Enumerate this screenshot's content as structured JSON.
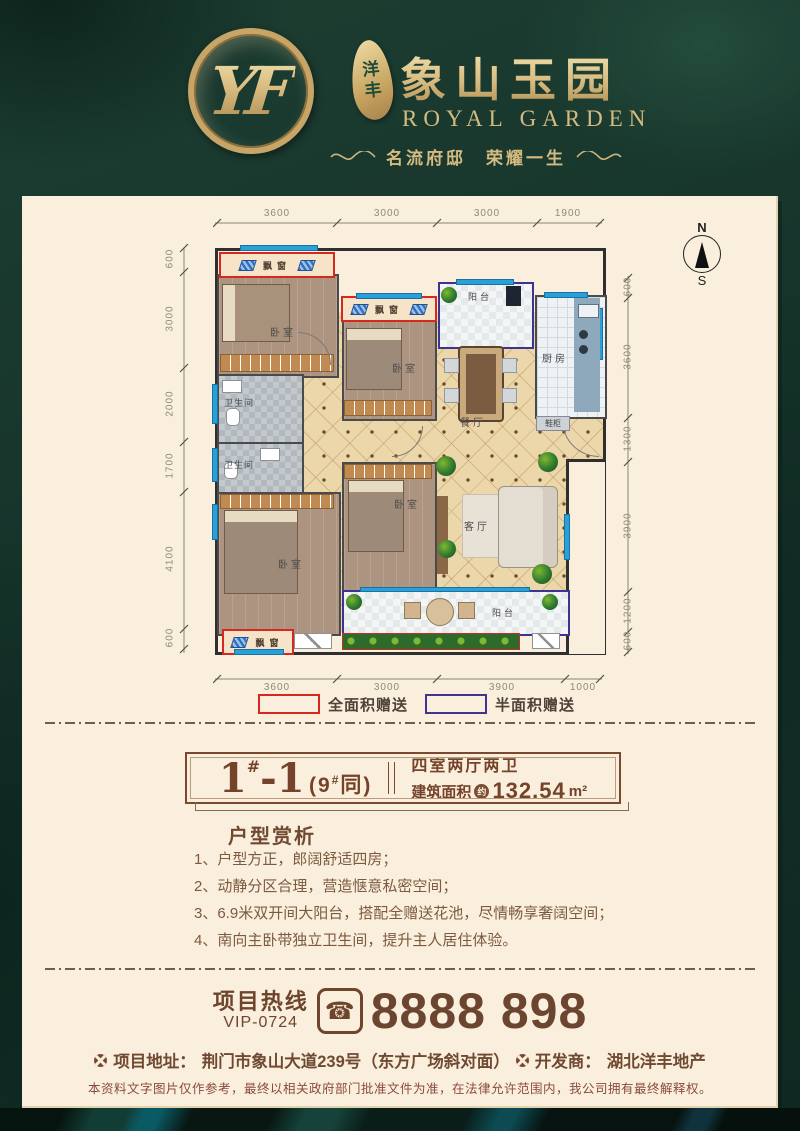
{
  "brand": {
    "monogram": "YF",
    "badge_top": "洋",
    "badge_bottom": "丰",
    "title": "象山玉园",
    "subtitle": "ROYAL  GARDEN",
    "tagline": "名流府邸　荣耀一生"
  },
  "plan": {
    "compass_n": "N",
    "compass_s": "S",
    "dims_top": [
      "3600",
      "3000",
      "3000",
      "1900"
    ],
    "dims_left": [
      "600",
      "3000",
      "2000",
      "1700",
      "4100",
      "600"
    ],
    "dims_right": [
      "600",
      "3600",
      "1300",
      "3900",
      "1200",
      "600"
    ],
    "dims_bottom": [
      "3600",
      "3000",
      "3900",
      "1000"
    ],
    "labels": {
      "bedroom": "卧室",
      "bath": "卫生间",
      "kitchen": "厨房",
      "dining": "餐厅",
      "living": "客厅",
      "balcony": "阳台",
      "bay": "飘窗",
      "shoe": "鞋柜"
    }
  },
  "legend": [
    {
      "label": "全面积赠送",
      "color": "#d5281f"
    },
    {
      "label": "半面积赠送",
      "color": "#3e3390"
    }
  ],
  "unit": {
    "big": "1",
    "sup": "#",
    "rest": "-1",
    "note_open": "(9",
    "note_sup": "#",
    "note_close": "同)"
  },
  "info": {
    "rooms": "四室两厅两卫",
    "area_label": "建筑面积",
    "area_circle": "约",
    "area_value": "132.54",
    "area_unit": "m²"
  },
  "analysis": {
    "heading": "户型赏析",
    "items": [
      "1、户型方正，郎阔舒适四房；",
      "2、动静分区合理，营造惬意私密空间；",
      "3、6.9米双开间大阳台，搭配全赠送花池，尽情畅享奢阔空间；",
      "4、南向主卧带独立卫生间，提升主人居住体验。"
    ]
  },
  "hotline": {
    "label": "项目热线",
    "vip": "VIP-0724",
    "phone_glyph": "☎",
    "number": "8888 898"
  },
  "footer": {
    "address_label": "项目地址：",
    "address": "荆门市象山大道239号（东方广场斜对面）",
    "developer_label": "开发商：",
    "developer": "湖北洋丰地产",
    "disclaimer": "本资料文字图片仅作参考，最终以相关政府部门批准文件为准，在法律允许范围内，我公司拥有最终解释权。"
  },
  "colors": {
    "gold": "#cfae6e",
    "red": "#d5281f",
    "purple": "#3e3390",
    "brown": "#74432a",
    "card": "#f9efdc",
    "window_blue": "#2b9fd8"
  }
}
